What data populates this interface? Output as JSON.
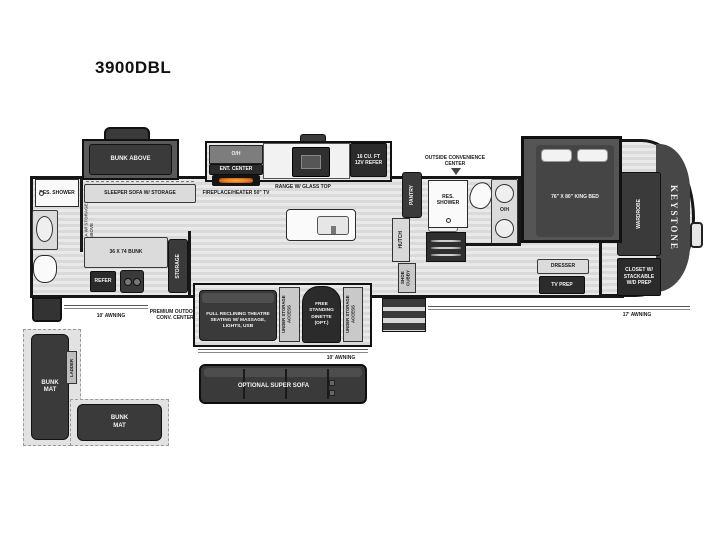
{
  "title": "3900DBL",
  "brand": "KEYSTONE",
  "colors": {
    "wall": "#181818",
    "floor": "#e2e2e2",
    "furniture_dark": "#3a3a3a",
    "flame": "#e8791f",
    "background": "#ffffff"
  },
  "rear": {
    "res_shower": "RES. SHOWER",
    "loft_wall": "LOFT AREA W/ STORAGE ABOVE",
    "sleeper_sofa": "SLEEPER SOFA W/ STORAGE",
    "bunk_above": "BUNK ABOVE",
    "bunk": "36 X 74 BUNK",
    "storage": "STORAGE",
    "refer": "REFER"
  },
  "exterior": {
    "awning_left": "10' AWNING",
    "premium_outdoor": "PREMIUM OUTDOOR CONV. CENTER",
    "awning_mid": "10' AWNING",
    "awning_right": "17' AWNING",
    "outside_conv": "OUTSIDE CONVENIENCE CENTER"
  },
  "kitchen": {
    "oh": "O/H",
    "ent_center": "ENT. CENTER",
    "fireplace": "FIREPLACE/HEATER 50\" TV",
    "range": "RANGE W/ GLASS TOP",
    "refer_12v": "16 CU. FT 12V REFER",
    "pantry": "PANTRY",
    "hutch": "HUTCH",
    "shoe_cubby": "SHOE CUBBY"
  },
  "bath_main": {
    "res_shower": "RES. SHOWER",
    "oh": "O/H"
  },
  "bedroom": {
    "king_bed": "76\" X 80\" KING BED",
    "dresser": "DRESSER",
    "tv_prep": "TV PREP",
    "wardrobe": "WARDROBE",
    "closet": "CLOSET W/ STACKABLE W/D PREP"
  },
  "living_slide": {
    "theater": "FULL RECLINING THEATRE SEATING W/ MASSAGE, LIGHTS, USB",
    "under_storage_left": "UNDER STORAGE ACCESS",
    "dinette": "FREE STANDING DINETTE (OPT.)",
    "under_storage_right": "UNDER STORAGE ACCESS",
    "super_sofa": "OPTIONAL SUPER SOFA"
  },
  "loft_diagram": {
    "bunk_mat_1": "BUNK MAT",
    "bunk_mat_2": "BUNK MAT",
    "ladder": "LADDER"
  }
}
